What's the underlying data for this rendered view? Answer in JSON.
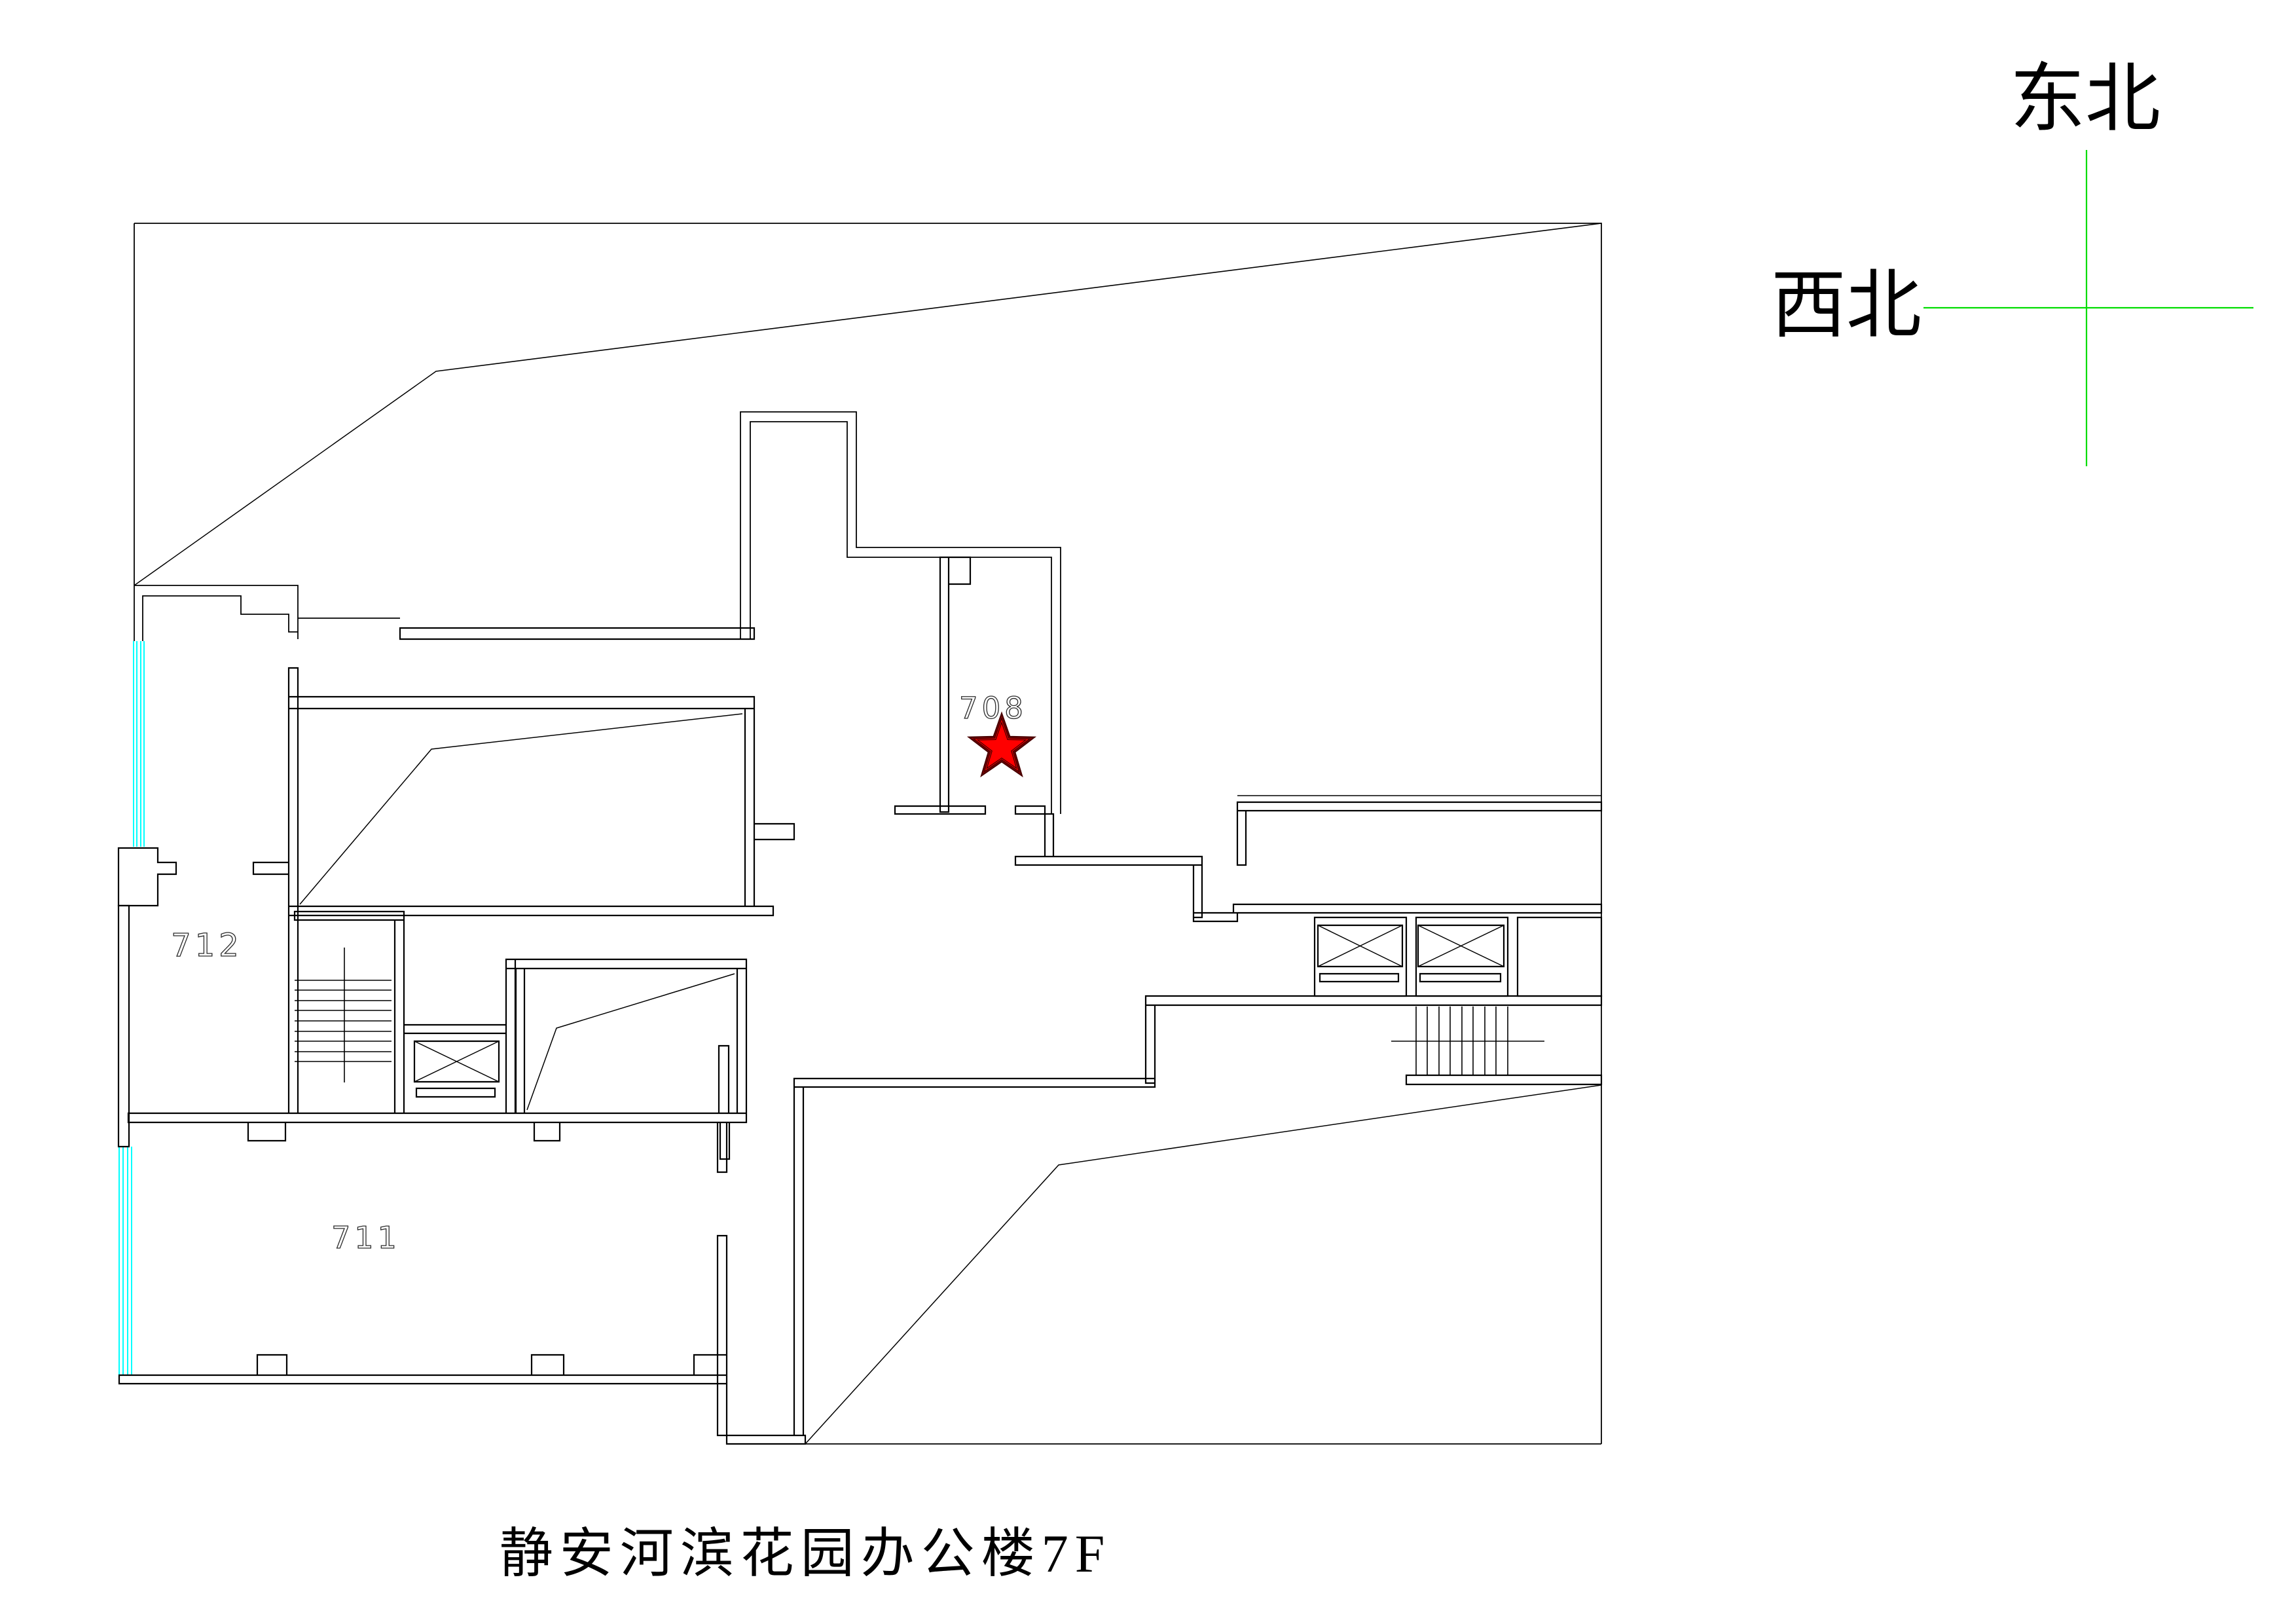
{
  "title": {
    "text": "静安河滨花园办公楼7F"
  },
  "compass": {
    "northeast_label": "东北",
    "northwest_label": "西北",
    "line_color": "#00dd00"
  },
  "rooms": {
    "r708": {
      "label": "708"
    },
    "r711": {
      "label": "711"
    },
    "r712": {
      "label": "712"
    }
  },
  "marker": {
    "color": "#ff0000",
    "outline": "#3c0000"
  },
  "colors": {
    "background": "#ffffff",
    "wall": "#000000",
    "window": "#00ffff",
    "label": "#2a2a2a"
  }
}
